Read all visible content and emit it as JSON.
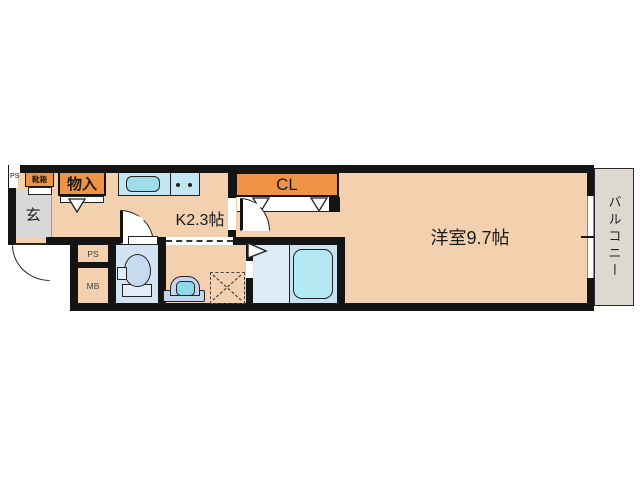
{
  "colors": {
    "floor_peach": "#f3d0ae",
    "storage_orange": "#ef9446",
    "entrance_gray": "#d8d8d8",
    "toilet_blue": "#d2e3f3",
    "bath_blue": "#dcebf7",
    "tub_cyan": "#b4e9f4",
    "counter_blue": "#c4e6f2",
    "balcony_gray": "#ddd8d0",
    "wall_black": "#141414"
  },
  "rooms": {
    "entrance": "玄",
    "kitchen": "K2.3帖",
    "western_room": "洋室9.7帖",
    "balcony": "バルコニー"
  },
  "storage": {
    "shoe_cabinet": "靴箱",
    "hall_closet": "物入",
    "closet": "CL"
  },
  "utility": {
    "pipe_space": "PS",
    "meter_box": "MB",
    "corner_pipe_space": "PS"
  }
}
